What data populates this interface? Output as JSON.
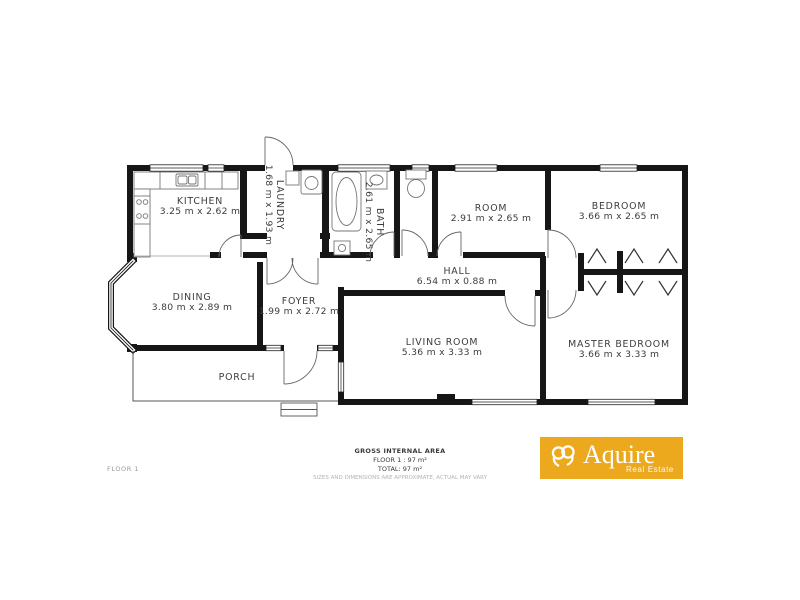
{
  "floor_label": "FLOOR 1",
  "rooms": {
    "kitchen": {
      "name": "KITCHEN",
      "dims": "3.25 m x 2.62 m"
    },
    "laundry": {
      "name": "LAUNDRY",
      "dims": "1.68 m x 1.93 m"
    },
    "bath": {
      "name": "BATH",
      "dims": "2.61 m x 2.65 m"
    },
    "room": {
      "name": "ROOM",
      "dims": "2.91 m x 2.65 m"
    },
    "bedroom": {
      "name": "BEDROOM",
      "dims": "3.66 m x 2.65 m"
    },
    "hall": {
      "name": "HALL",
      "dims": "6.54 m x 0.88 m"
    },
    "dining": {
      "name": "DINING",
      "dims": "3.80 m x 2.89 m"
    },
    "foyer": {
      "name": "FOYER",
      "dims": "1.99 m x 2.72 m"
    },
    "living_room": {
      "name": "LIVING ROOM",
      "dims": "5.36 m x 3.33 m"
    },
    "master_bedroom": {
      "name": "MASTER BEDROOM",
      "dims": "3.66 m x 3.33 m"
    },
    "porch": {
      "name": "PORCH"
    }
  },
  "area_summary": {
    "title": "GROSS INTERNAL AREA",
    "floor_line": "FLOOR 1 : 97 m²",
    "total_line": "TOTAL: 97 m²",
    "disclaimer": "SIZES AND DIMENSIONS ARE APPROXIMATE, ACTUAL MAY VARY"
  },
  "logo": {
    "brand": "Aquire",
    "tagline": "Real Estate",
    "background": "#EDA91E",
    "text_color": "#FFFFFF"
  },
  "colors": {
    "wall": "#161616",
    "label": "#3c3c3c",
    "muted": "#9a9a9a"
  }
}
